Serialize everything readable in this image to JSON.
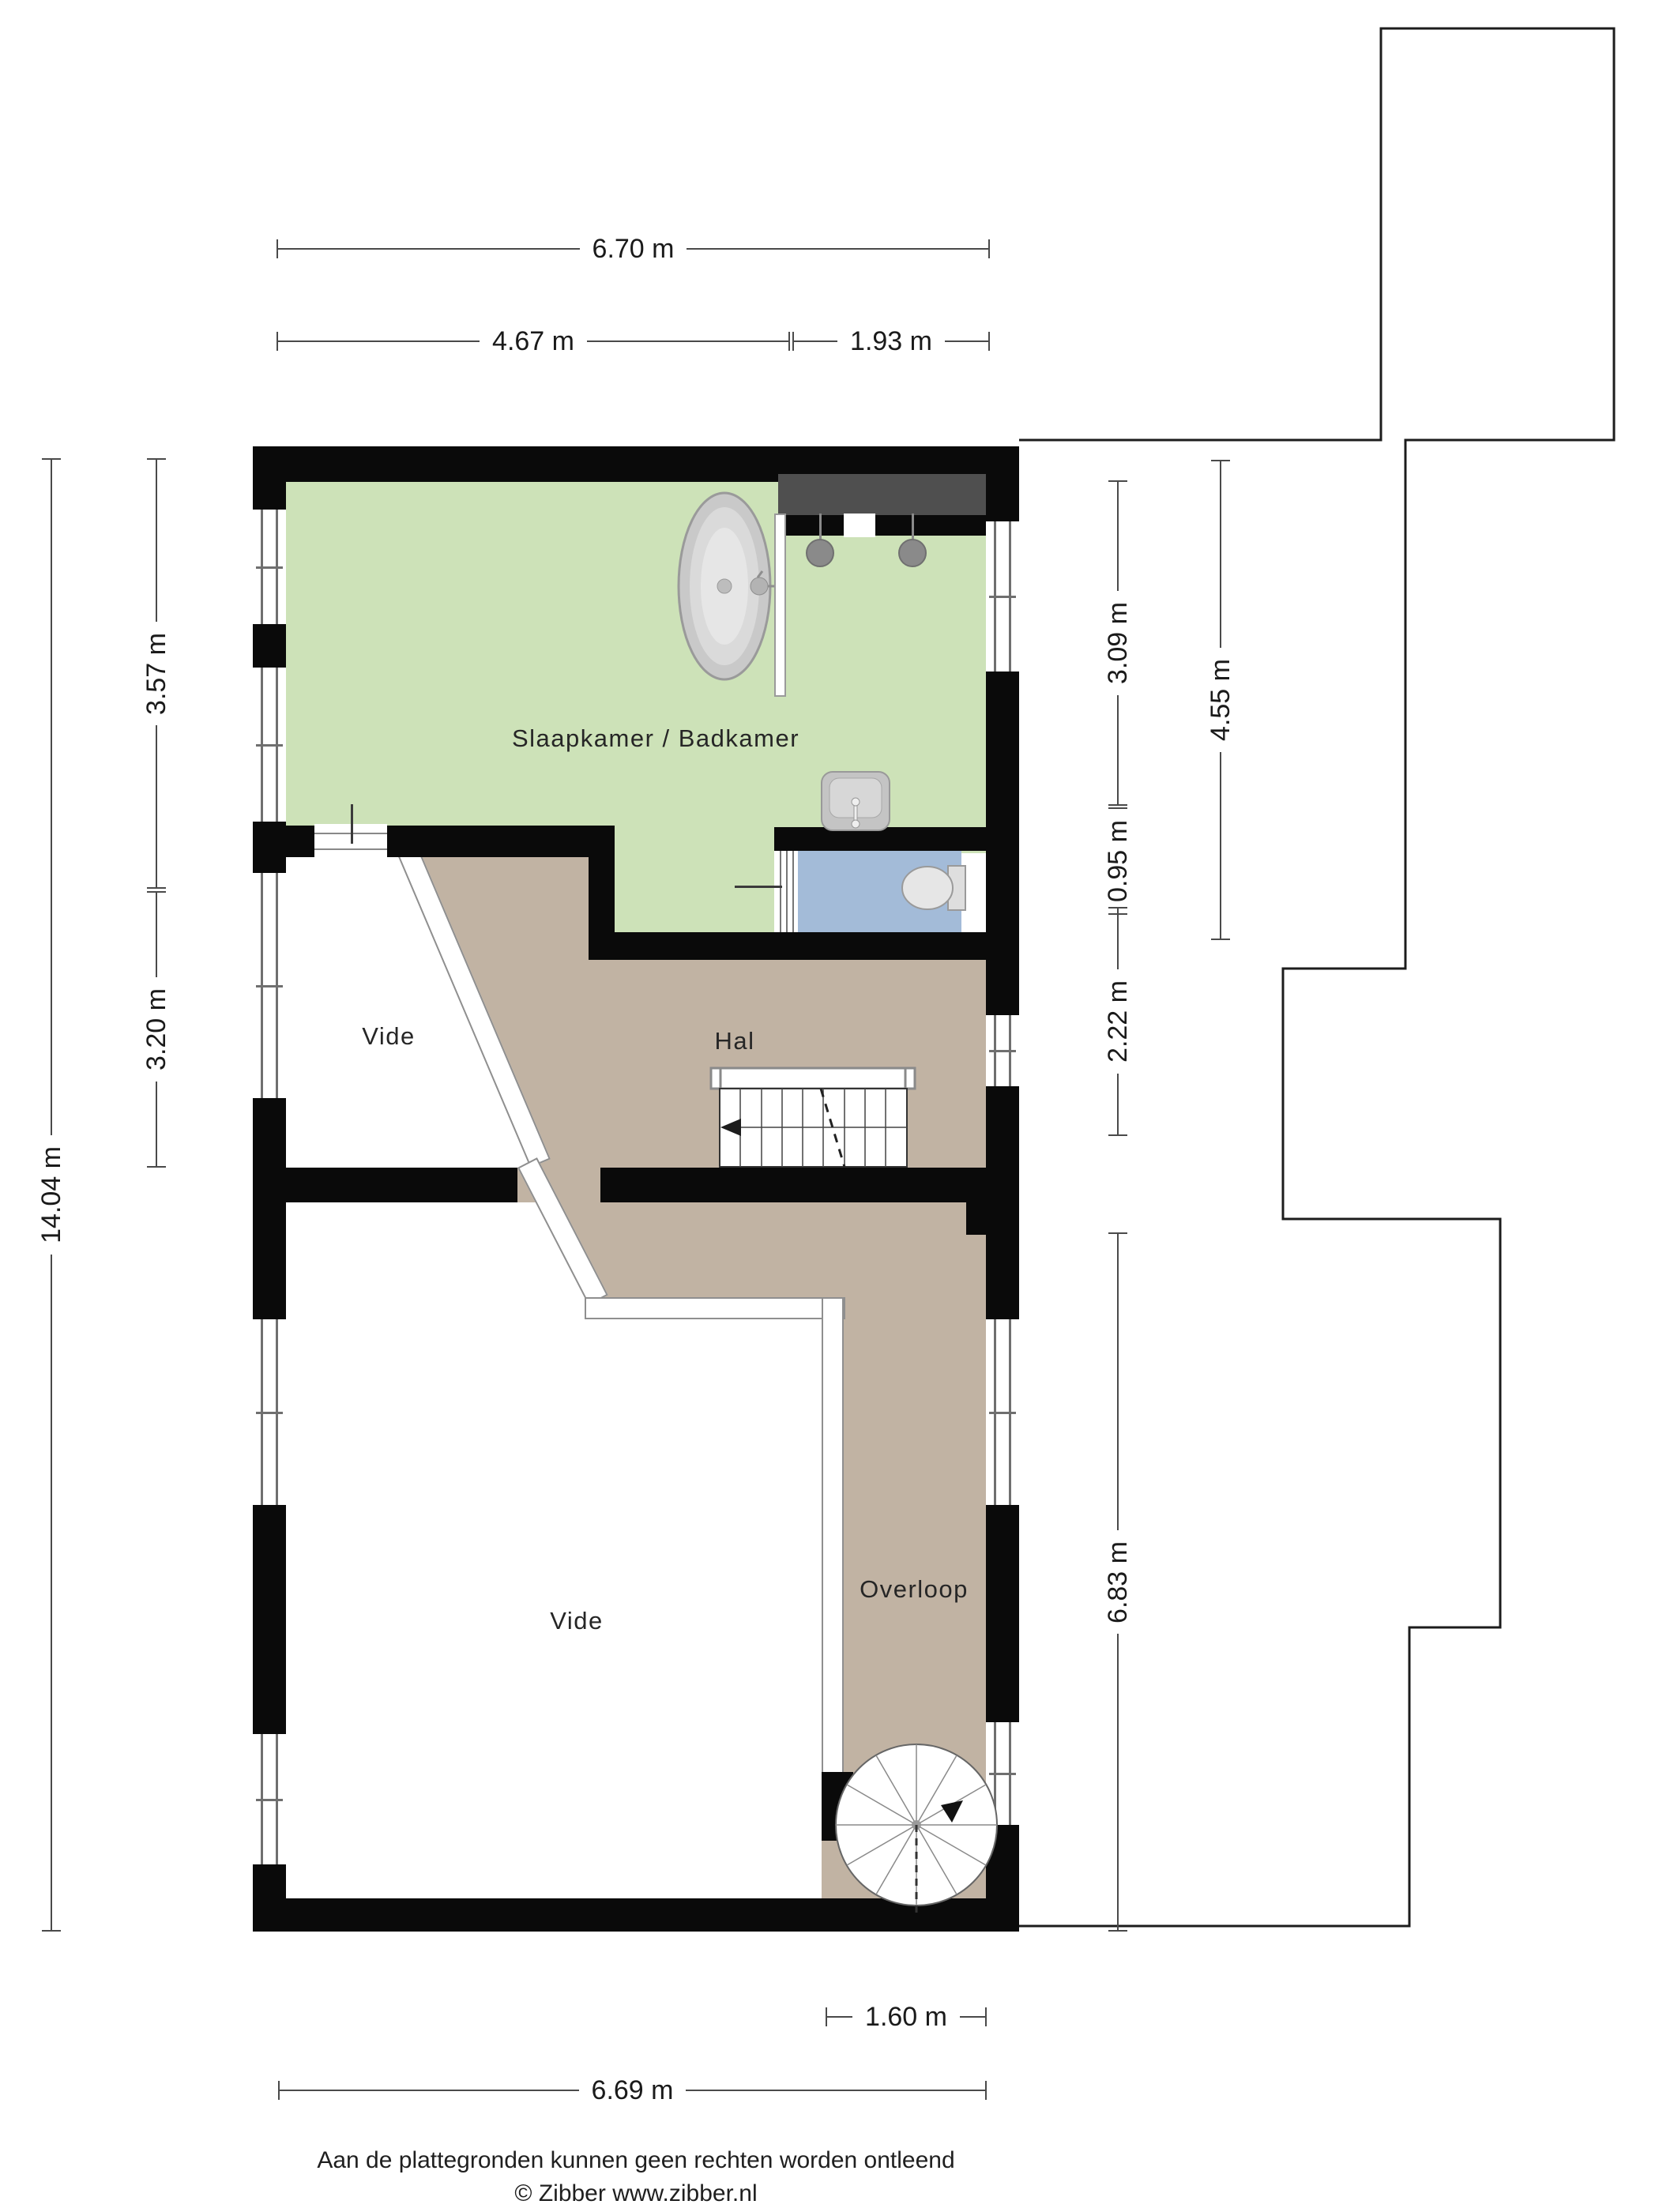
{
  "rooms": {
    "bedroom": "Slaapkamer / Badkamer",
    "hal": "Hal",
    "vide_upper": "Vide",
    "vide_lower": "Vide",
    "overloop": "Overloop"
  },
  "dims": {
    "d670": "6.70 m",
    "d467": "4.67 m",
    "d193": "1.93 m",
    "d357": "3.57 m",
    "d320": "3.20 m",
    "d1404": "14.04 m",
    "d309": "3.09 m",
    "d095": "0.95 m",
    "d222": "2.22 m",
    "d455": "4.55 m",
    "d683": "6.83 m",
    "d160": "1.60 m",
    "d669": "6.69 m"
  },
  "footer": {
    "disclaimer": "Aan de plattegronden kunnen geen rechten worden ontleend",
    "credit": "© Zibber www.zibber.nl"
  },
  "colors": {
    "bedroom": "#cde2b8",
    "wc": "#a3bbd8",
    "hall": "#c1b3a3",
    "wall": "#0a0a0a",
    "closet": "#4f4f4f",
    "fixture": "#cfcfcf",
    "dimline": "#4a4a4a",
    "dimtext": "#1a1a1a"
  }
}
